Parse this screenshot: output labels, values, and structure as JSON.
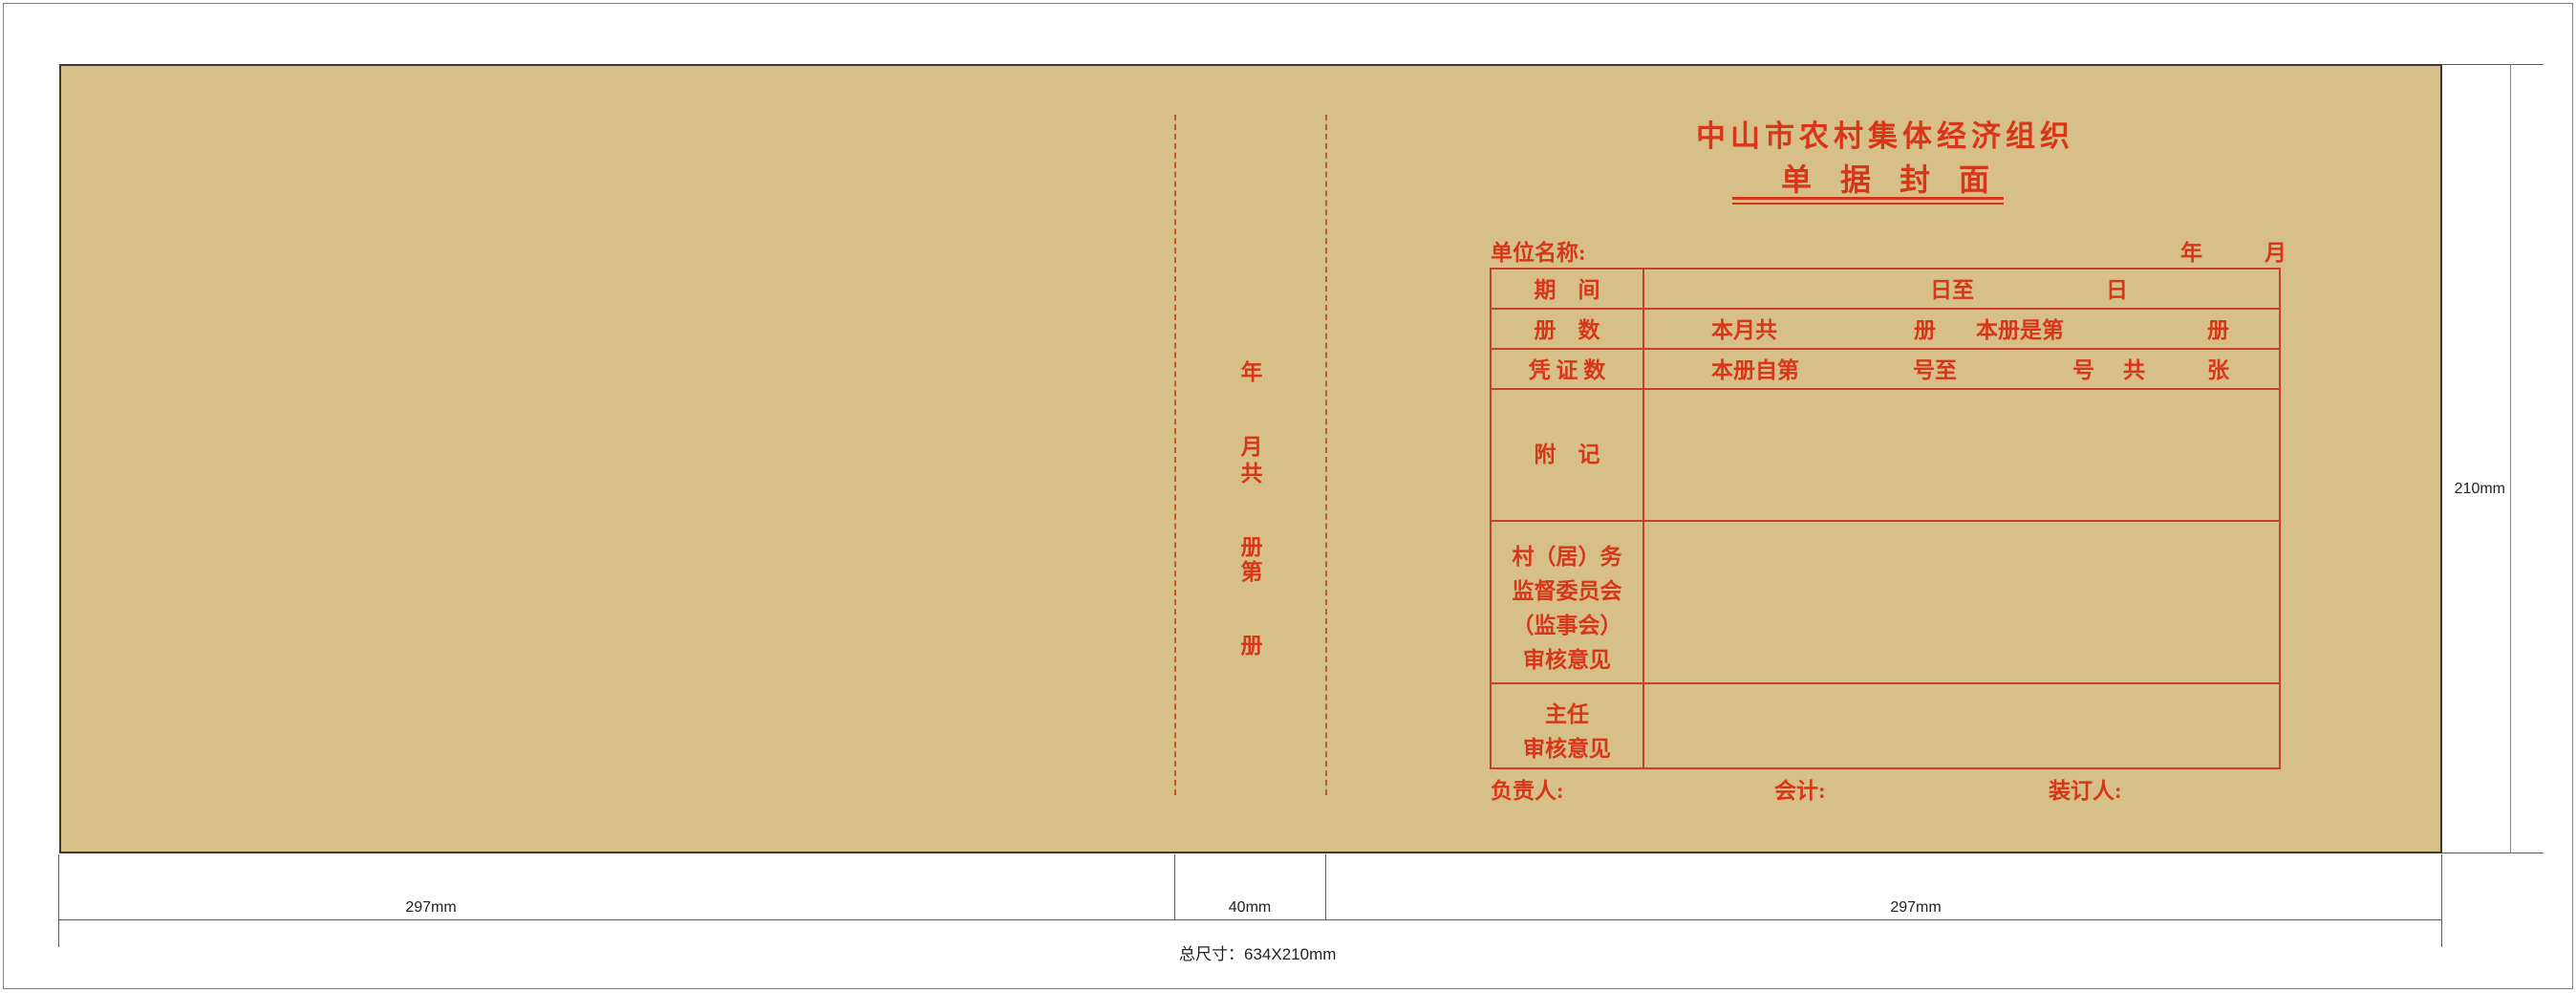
{
  "cover": {
    "org_title": "中山市农村集体经济组织",
    "doc_title": "单据封面",
    "unit_label": "单位名称:",
    "year_label": "年",
    "month_label": "月",
    "spine": {
      "chars": [
        "年",
        "月",
        "共",
        "册",
        "第",
        "册"
      ]
    },
    "table": {
      "rows": [
        {
          "label": "期　间",
          "cells": [
            "日至",
            "日"
          ]
        },
        {
          "label": "册　数",
          "cells": [
            "本月共",
            "册",
            "本册是第",
            "册"
          ]
        },
        {
          "label": "凭 证 数",
          "cells": [
            "本册自第",
            "号至",
            "号",
            "共",
            "张"
          ]
        },
        {
          "label": "附　记",
          "cells": []
        },
        {
          "label_lines": [
            "村（居）务",
            "监督委员会",
            "（监事会）",
            "审核意见"
          ],
          "cells": []
        },
        {
          "label_lines": [
            "主任",
            "审核意见"
          ],
          "cells": []
        }
      ]
    },
    "footer": {
      "manager": "负责人:",
      "accountant": "会计:",
      "binder": "装订人:"
    }
  },
  "dimensions": {
    "panel_left_width": "297mm",
    "spine_width": "40mm",
    "panel_right_width": "297mm",
    "height": "210mm",
    "total": "总尺寸：634X210mm"
  },
  "colors": {
    "kraft": "#d7bf88",
    "print_red": "#d8361b",
    "table_line_red": "#c7402b",
    "fold_dash": "#c05a2e",
    "dimension_line": "#5a5a5a"
  }
}
